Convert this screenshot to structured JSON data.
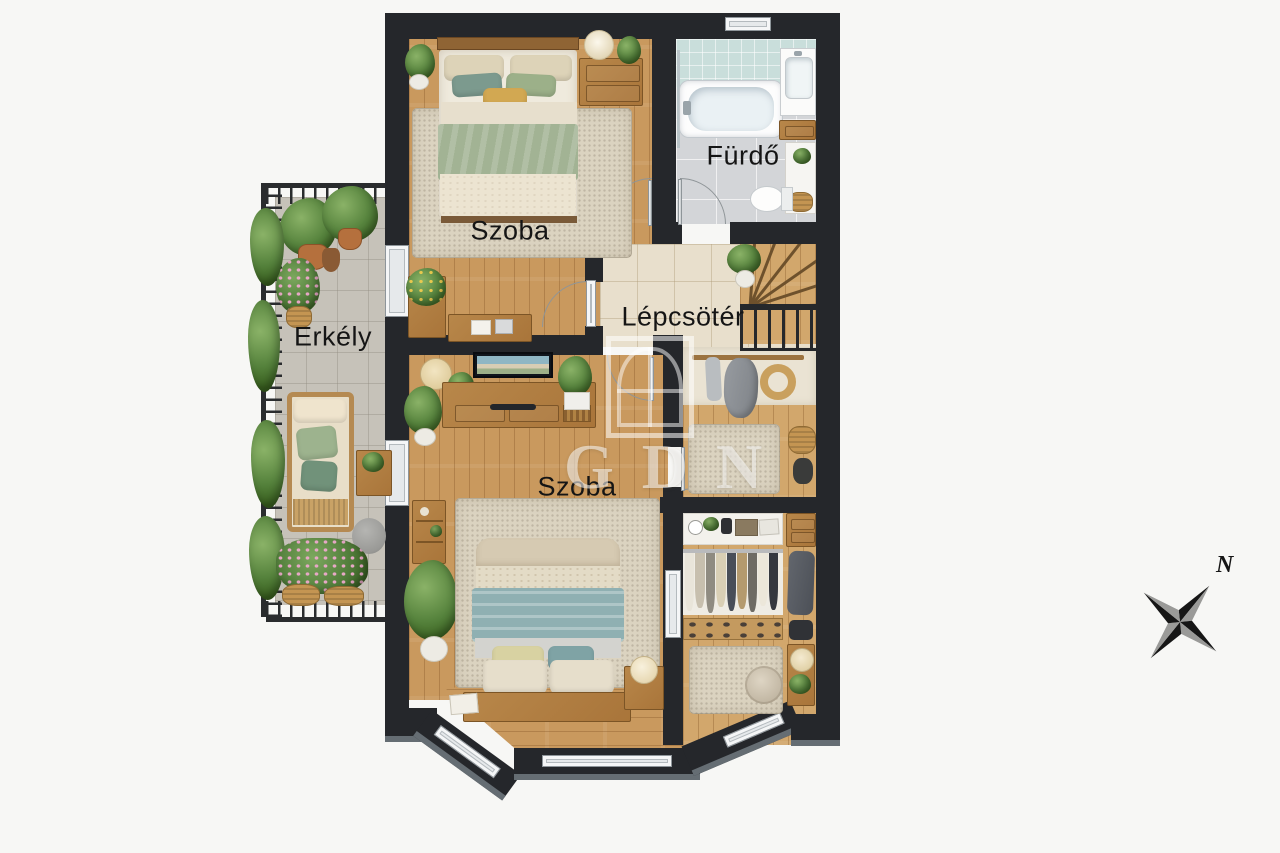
{
  "rooms": {
    "bedroom_top": {
      "label": "Szoba"
    },
    "bathroom": {
      "label": "Fürdő"
    },
    "stairwell": {
      "label": "Lépcsötér"
    },
    "bedroom_main": {
      "label": "Szoba"
    },
    "balcony": {
      "label": "Erkély"
    }
  },
  "watermark": {
    "text": "GDN",
    "logo": "window-icon"
  },
  "compass": {
    "north_label": "N"
  },
  "colors": {
    "background": "#f7f7f5",
    "wall": "#25272b",
    "wood_floor": "#c9995e",
    "hall_tile": "#e8dfcc",
    "bathroom_tile": "#d3d5d8",
    "bathroom_wall_tile": "#c9dedb",
    "balcony_stone": "#c6c2b9",
    "rug": "#dbd3c0",
    "blanket_green": "#a2b394",
    "blanket_teal": "#8fb0b2",
    "plant_green": "#55823c",
    "label_text": "#151515",
    "watermark_white": "#ffffff"
  }
}
